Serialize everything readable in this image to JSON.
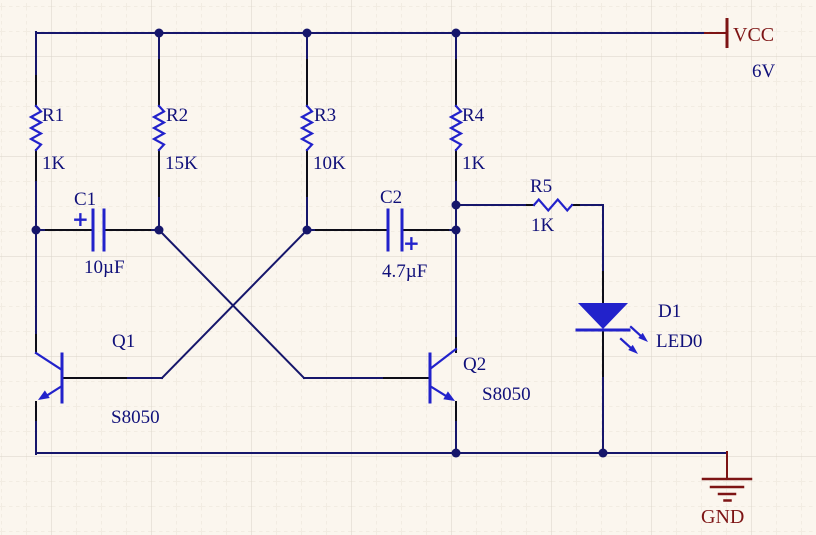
{
  "power": {
    "vcc_label": "VCC",
    "vcc_voltage": "6V",
    "gnd_label": "GND"
  },
  "components": {
    "r1": {
      "ref": "R1",
      "value": "1K"
    },
    "r2": {
      "ref": "R2",
      "value": "15K"
    },
    "r3": {
      "ref": "R3",
      "value": "10K"
    },
    "r4": {
      "ref": "R4",
      "value": "1K"
    },
    "r5": {
      "ref": "R5",
      "value": "1K"
    },
    "c1": {
      "ref": "C1",
      "value": "10µF",
      "polarity": "+"
    },
    "c2": {
      "ref": "C2",
      "value": "4.7µF",
      "polarity": "+"
    },
    "q1": {
      "ref": "Q1",
      "value": "S8050"
    },
    "q2": {
      "ref": "Q2",
      "value": "S8050"
    },
    "d1": {
      "ref": "D1",
      "value": "LED0"
    }
  },
  "colors": {
    "wire": "#16166b",
    "component": "#2222cb",
    "label": "#10107a",
    "power": "#7d1414",
    "background": "#fbf6ee"
  }
}
